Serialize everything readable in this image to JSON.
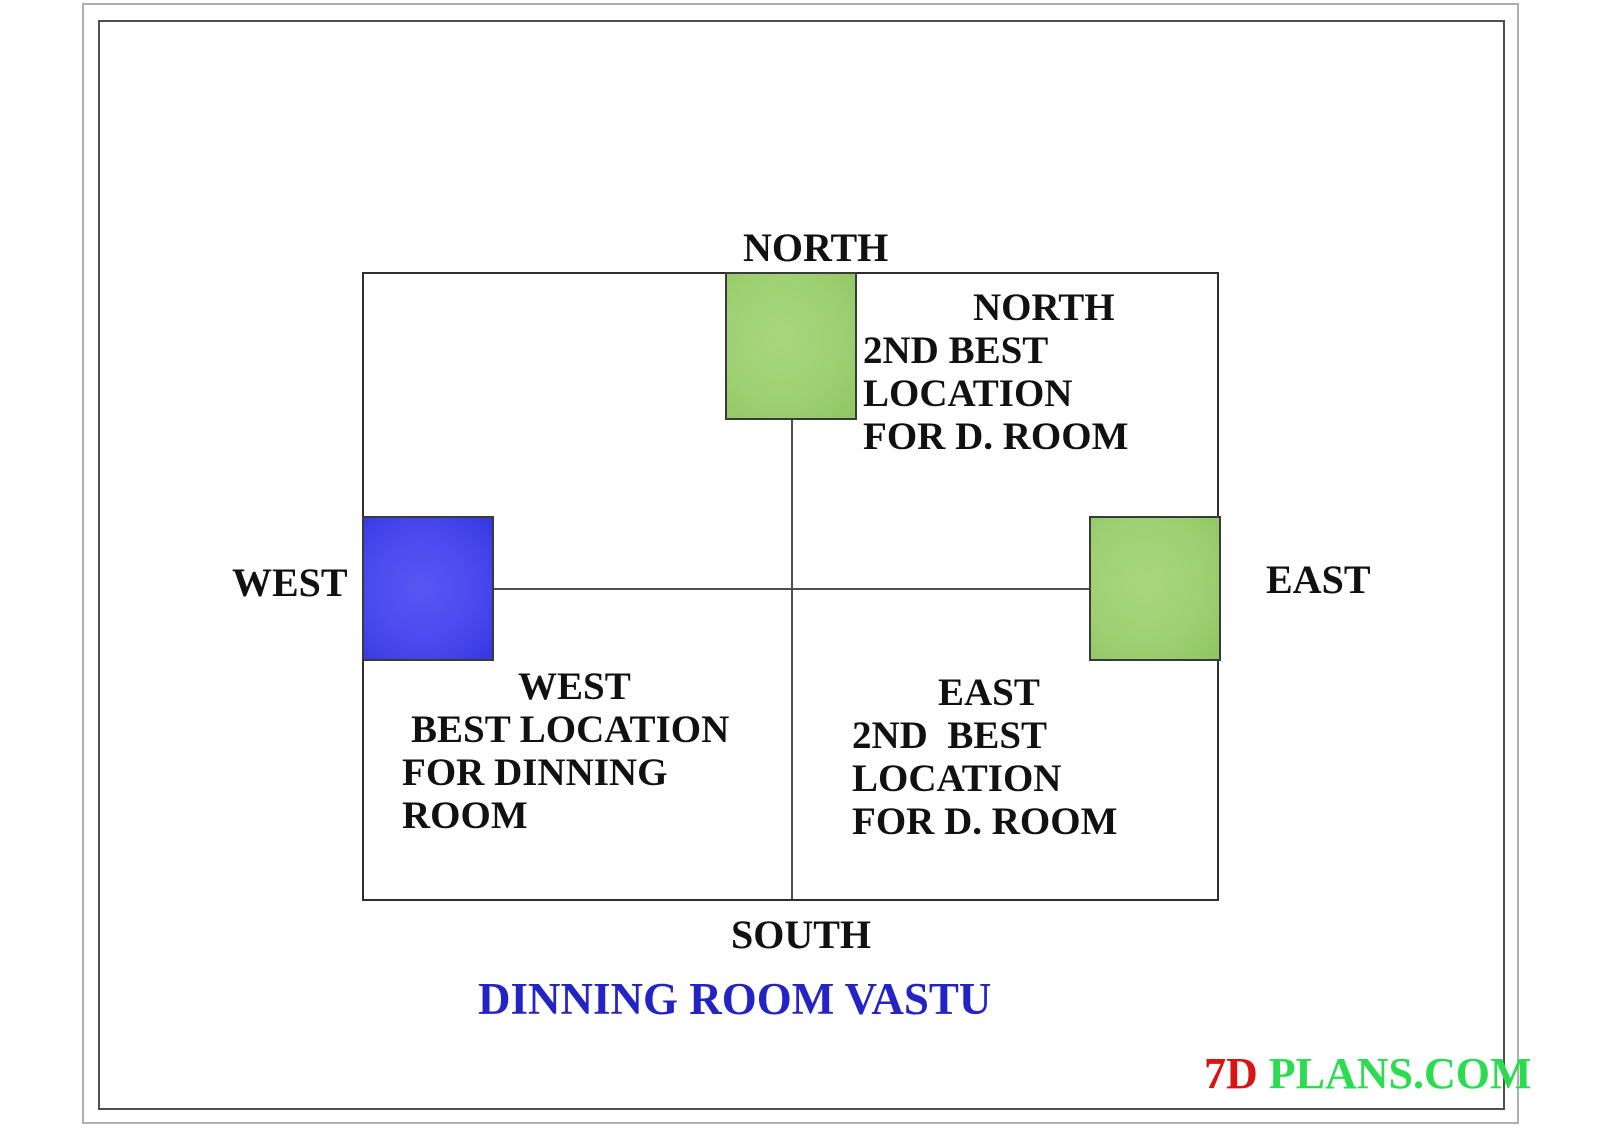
{
  "compass": {
    "north": "NORTH",
    "south": "SOUTH",
    "east": "EAST",
    "west": "WEST"
  },
  "notes": {
    "north_quadrant": {
      "lines": [
        "NORTH",
        "2ND BEST",
        "LOCATION",
        "FOR D. ROOM"
      ]
    },
    "west_quadrant": {
      "lines": [
        "WEST",
        "BEST LOCATION",
        "FOR DINNING",
        "ROOM"
      ]
    },
    "east_quadrant": {
      "lines": [
        "EAST",
        "2ND  BEST",
        "LOCATION",
        "FOR D. ROOM"
      ]
    }
  },
  "boxes": {
    "north_fill": "#9ED173",
    "west_fill": "#4A4AEF",
    "east_fill": "#9ED173"
  },
  "title": {
    "text": "DINNING ROOM VASTU",
    "color": "#2424C4"
  },
  "watermark": {
    "prefix": "7D",
    "suffix": " PLANS.COM",
    "prefix_color": "#D81515",
    "suffix_color": "#2BDC50"
  }
}
